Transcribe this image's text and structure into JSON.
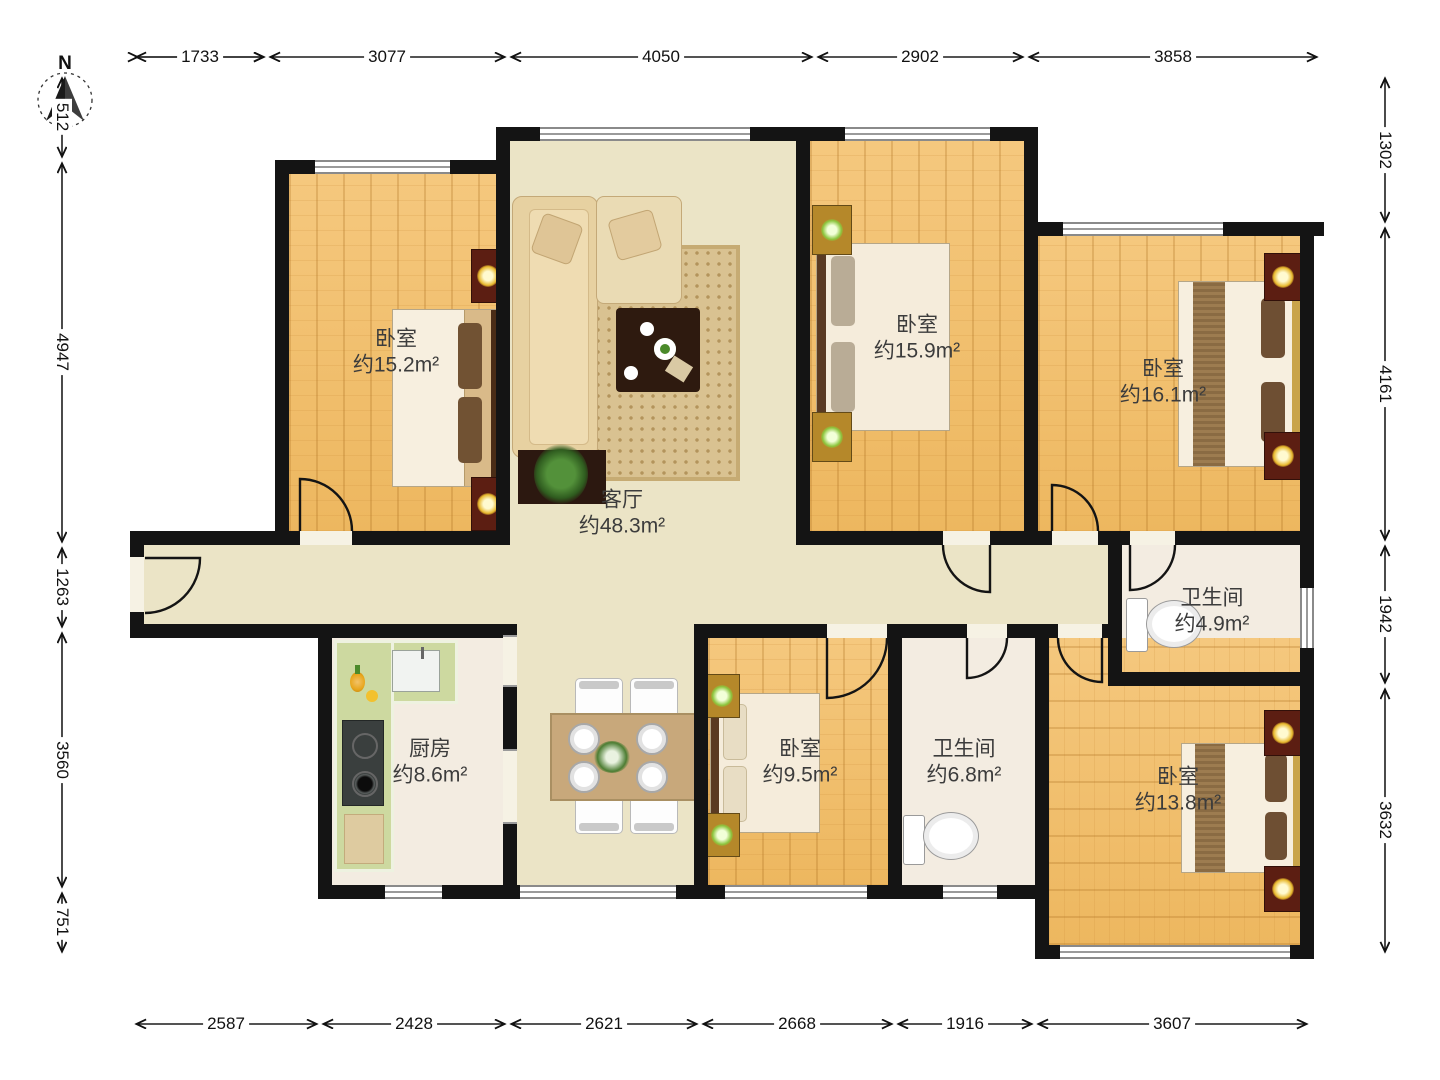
{
  "compass": {
    "label": "N"
  },
  "rooms": {
    "bedroom_top_left": {
      "name": "卧室",
      "area": "约15.2m²"
    },
    "living_room": {
      "name": "客厅",
      "area": "约48.3m²"
    },
    "bedroom_top_middle": {
      "name": "卧室",
      "area": "约15.9m²"
    },
    "bedroom_top_right": {
      "name": "卧室",
      "area": "约16.1m²"
    },
    "bathroom_right": {
      "name": "卫生间",
      "area": "约4.9m²"
    },
    "kitchen": {
      "name": "厨房",
      "area": "约8.6m²"
    },
    "bedroom_bottom_middle": {
      "name": "卧室",
      "area": "约9.5m²"
    },
    "bathroom_bottom": {
      "name": "卫生间",
      "area": "约6.8m²"
    },
    "bedroom_bottom_right": {
      "name": "卧室",
      "area": "约13.8m²"
    }
  },
  "dimensions": {
    "top": [
      "1733",
      "3077",
      "4050",
      "2902",
      "3858"
    ],
    "bottom": [
      "2587",
      "2428",
      "2621",
      "2668",
      "1916",
      "3607"
    ],
    "left": [
      "512",
      "4947",
      "1263",
      "3560",
      "751"
    ],
    "right": [
      "1302",
      "4161",
      "1942",
      "3632"
    ]
  },
  "colors": {
    "wall": "#141414",
    "wood_floor": "#f2c06e",
    "public_floor": "#ebe4c6",
    "wet_floor": "#f3ece1",
    "kitchen_counter": "#cdd9a0"
  }
}
